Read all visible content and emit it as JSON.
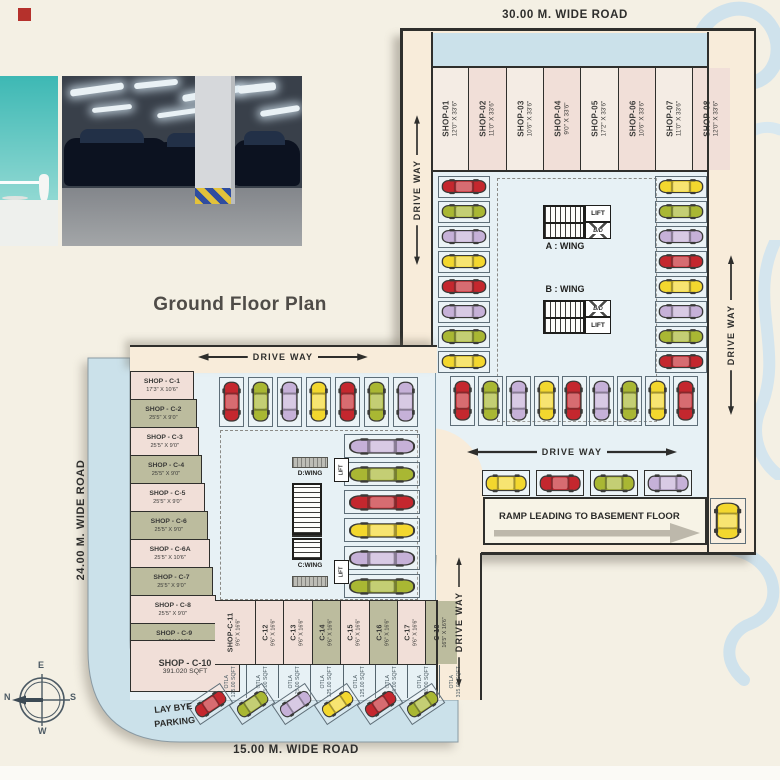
{
  "title": "Ground Floor Plan",
  "roads": {
    "top": "30.00 M. WIDE ROAD",
    "left": "24.00 M. WIDE ROAD",
    "bottom": "15.00 M. WIDE ROAD"
  },
  "labels": {
    "driveway": "DRIVE WAY",
    "ramp": "RAMP LEADING TO BASEMENT FLOOR",
    "laybye_line1": "LAY BYE",
    "laybye_line2": "PARKING",
    "lift": "LIFT",
    "duct": "B/D",
    "wing_a": "A : WING",
    "wing_b": "B : WING",
    "wing_c": "C:WING",
    "wing_d": "D:WING"
  },
  "compass": {
    "top": "E",
    "left": "N",
    "right": "S",
    "bottom": "W"
  },
  "top_shops": [
    {
      "name": "SHOP-01",
      "dims": "12'0\" X 33'6\"",
      "w": 12
    },
    {
      "name": "SHOP-02",
      "dims": "11'0\" X 33'6\"",
      "w": 11
    },
    {
      "name": "SHOP-03",
      "dims": "10'6\" X 33'6\"",
      "w": 10.5
    },
    {
      "name": "SHOP-04",
      "dims": "9'0\" X 33'6\"",
      "w": 9
    },
    {
      "name": "SHOP-05",
      "dims": "17'2\" X 33'6\"",
      "w": 17.2
    },
    {
      "name": "SHOP-06",
      "dims": "10'6\" X 33'6\"",
      "w": 10.5
    },
    {
      "name": "SHOP-07",
      "dims": "11'0\" X 33'6\"",
      "w": 11
    },
    {
      "name": "SHOP-08",
      "dims": "12'0\" X 33'6\"",
      "w": 12
    }
  ],
  "left_shops": [
    {
      "name": "SHOP - C-1",
      "dims": "17'3\" X 10'6\""
    },
    {
      "name": "SHOP - C-2",
      "dims": "25'5\" X 9'0\""
    },
    {
      "name": "SHOP - C-3",
      "dims": "25'5\" X 9'0\""
    },
    {
      "name": "SHOP - C-4",
      "dims": "25'5\" X 9'0\""
    },
    {
      "name": "SHOP - C-5",
      "dims": "25'5\" X 9'0\""
    },
    {
      "name": "SHOP - C-6",
      "dims": "25'5\" X 9'0\""
    },
    {
      "name": "SHOP - C-6A",
      "dims": "25'5\" X 10'6\""
    },
    {
      "name": "SHOP - C-7",
      "dims": "25'5\" X 9'0\""
    },
    {
      "name": "SHOP - C-8",
      "dims": "25'5\" X 9'0\""
    },
    {
      "name": "SHOP - C-9",
      "dims": "25'5\" X 11'6\""
    }
  ],
  "corner_shop": {
    "name": "SHOP - C-10",
    "dims": "391.020 SQFT"
  },
  "bottom_shops": [
    {
      "name": "SHOP-C-11",
      "dims": "9'6\" X 16'6\"",
      "otla_1": "OTLA",
      "otla_2": "125.00 SQFT",
      "w": 13
    },
    {
      "name": "C-12",
      "dims": "9'6\" X 16'6\"",
      "otla_1": "OTLA",
      "otla_2": "125.00 SQFT",
      "w": 9.5
    },
    {
      "name": "C-13",
      "dims": "9'6\" X 16'6\"",
      "otla_1": "OTLA",
      "otla_2": "125.00 SQFT",
      "w": 9.5
    },
    {
      "name": "C-14",
      "dims": "9'6\" X 16'6\"",
      "otla_1": "OTLA",
      "otla_2": "125.00 SQFT",
      "w": 9.5
    },
    {
      "name": "C-15",
      "dims": "9'6\" X 16'6\"",
      "otla_1": "OTLA",
      "otla_2": "125.00 SQFT",
      "w": 9.5
    },
    {
      "name": "C-16",
      "dims": "9'6\" X 16'6\"",
      "otla_1": "OTLA",
      "otla_2": "125.00 SQFT",
      "w": 9.5
    },
    {
      "name": "C-17",
      "dims": "9'6\" X 16'6\"",
      "otla_1": "OTLA",
      "otla_2": "125.00 SQFT",
      "w": 9.5
    },
    {
      "name": "C-18",
      "dims": "16'5\" X 16'6\"",
      "otla_1": "OTLA",
      "otla_2": "315.00 SQFT",
      "w": 16.5
    }
  ],
  "parking": {
    "right_block_left_column": [
      "red",
      "green",
      "purple",
      "yellow",
      "red",
      "purple",
      "green",
      "yellow"
    ],
    "right_block_right_column": [
      "yellow",
      "green",
      "purple",
      "red",
      "yellow",
      "purple",
      "green",
      "red"
    ],
    "right_block_bottom_row": [
      "red",
      "green",
      "purple",
      "yellow",
      "red",
      "purple",
      "green",
      "yellow",
      "red"
    ],
    "right_block_driveway_row": [
      "yellow",
      "red",
      "green",
      "purple"
    ],
    "right_block_ramp_side": [
      "yellow"
    ],
    "left_block_top_row": [
      "red",
      "green",
      "purple",
      "yellow",
      "red",
      "green",
      "purple"
    ],
    "left_block_right_column": [
      "purple",
      "green",
      "red",
      "yellow",
      "purple",
      "green"
    ],
    "laybye_row": [
      "red",
      "green",
      "purple",
      "yellow",
      "red",
      "green"
    ]
  },
  "colors": {
    "red": "#c4272e",
    "yellow": "#f3d72e",
    "green": "#a9b733",
    "purple": "#c6b1d8",
    "road_blue": "#cbe1ea",
    "plan_blue": "#e7f1f5",
    "driveway_cream": "#f8ecda",
    "shop_pink": "#f1dfd8",
    "shop_olive": "#bcbc9e",
    "wall": "#2f2f2c",
    "ramp_arrow": "#bdb8ab"
  }
}
